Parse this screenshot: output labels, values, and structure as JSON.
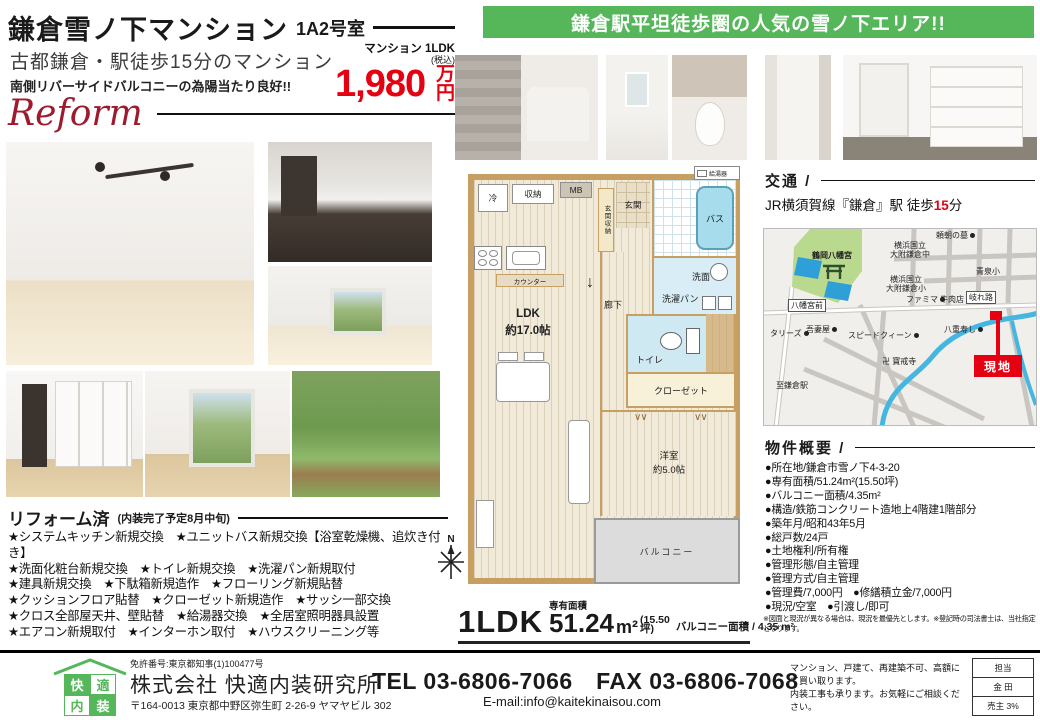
{
  "header": {
    "title": "鎌倉雪ノ下マンション",
    "unit": "1A2号室",
    "catch1": "古都鎌倉・駅徒歩15分のマンション",
    "catch2": "南側リバーサイドバルコニーの為陽当たり良好!!",
    "reform_script": "Reform",
    "price": {
      "type_label": "マンション 1LDK",
      "tax_note": "(税込)",
      "amount": "1,980",
      "unit": "万円"
    }
  },
  "banner": {
    "text": "鎌倉駅平坦徒歩圏の人気の雪ノ下エリア!!",
    "bg_color": "#55b65a"
  },
  "access": {
    "heading": "交通 /",
    "route_prefix": "JR横須賀線『鎌倉』駅 徒歩",
    "minutes": "15",
    "suffix": "分"
  },
  "map": {
    "labels": [
      "鶴岡八幡宮",
      "頼朝の墓",
      "横浜国立\n大附鎌倉中",
      "横浜国立\n大附鎌倉小",
      "青泉小",
      "八幡宮前",
      "ファミマ",
      "牛肉店",
      "岐れ路",
      "八重寿し",
      "タリーズ",
      "吾妻屋",
      "スピードクィーン",
      "卍 寶戒寺",
      "至鎌倉駅",
      "現地"
    ]
  },
  "floorplan": {
    "fridge": "冷",
    "storage": "収納",
    "mb": "MB",
    "entrance_storage": "玄関収納",
    "entrance": "玄関",
    "bath": "バス",
    "water_heater": "給湯器",
    "washroom": "洗面",
    "laundry_pan": "洗濯パン",
    "toilet": "トイレ",
    "closet": "クローゼット",
    "hall": "廊下",
    "hall_arrow": "↓",
    "counter": "カウンター",
    "ldk_name": "LDK",
    "ldk_size": "約17.0帖",
    "western_room": "洋室",
    "western_room_size": "約5.0帖",
    "balcony": "バルコニー",
    "compass_n": "N"
  },
  "plan_summary": {
    "layout": "1LDK",
    "area_label": "専有面積",
    "area": "51.24",
    "area_unit": "m²",
    "tsubo": "(15.50坪)",
    "balcony_area": "バルコニー面積 / 4.35 m²"
  },
  "overview": {
    "heading": "物件概要 /",
    "items": [
      "●所在地/鎌倉市雪ノ下4-3-20",
      "●専有面積/51.24m²(15.50坪)",
      "●バルコニー面積/4.35m²",
      "●構造/鉄筋コンクリート造地上4階建1階部分",
      "●築年月/昭和43年5月",
      "●総戸数/24戸",
      "●土地権利/所有権",
      "●管理形態/自主管理",
      "●管理方式/自主管理",
      "●管理費/7,000円　●修繕積立金/7,000円",
      "●現況/空室　●引渡し/即可"
    ],
    "note": "※図面と現況が異なる場合は、現況を最優先とします。※登記時の司法書士は、当社指定となります。"
  },
  "reform": {
    "heading": "リフォーム済",
    "subheading": "(内装完了予定8月中旬)",
    "lines": [
      "★システムキッチン新規交換　★ユニットバス新規交換【浴室乾燥機、追炊き付き】",
      "★洗面化粧台新規交換　★トイレ新規交換　★洗濯パン新規取付",
      "★建具新規交換　★下駄箱新規造作　★フローリング新規貼替",
      "★クッションフロア貼替　★クローゼット新規造作　★サッシ一部交換",
      "★クロス全部屋天井、壁貼替　★給湯器交換　★全居室照明器具設置",
      "★エアコン新規取付　★インターホン取付　★ハウスクリーニング等"
    ]
  },
  "footer": {
    "license": "免許番号:東京都知事(1)100477号",
    "company": "株式会社 快適内装研究所",
    "address": "〒164-0013 東京都中野区弥生町 2-26-9 ヤマヤビル 302",
    "telfax": "TEL 03-6806-7066　FAX 03-6806-7068",
    "email": "E-mail:info@kaitekinaisou.com",
    "pitch1": "マンション、戸建て、再建築不可、高額にて買い取ります。",
    "pitch2": "内装工事も承ります。お気軽にご相談ください。",
    "logo_chars": [
      "快",
      "適",
      "内",
      "装"
    ],
    "staff_table": [
      "担当",
      "金 田",
      "売主 3%"
    ]
  }
}
